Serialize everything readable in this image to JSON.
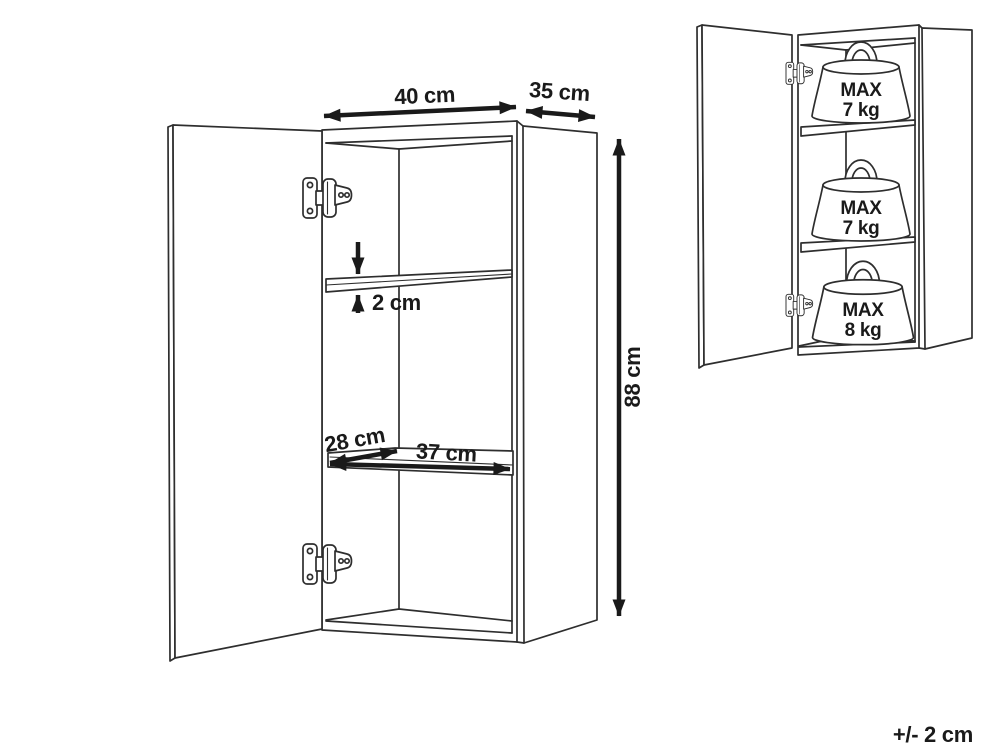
{
  "dimension_view": {
    "width_label": "40 cm",
    "depth_label": "35 cm",
    "height_label": "88 cm",
    "shelf_thickness_label": "2 cm",
    "interior_depth_label": "28 cm",
    "interior_width_label": "37 cm"
  },
  "load_view": {
    "weights": [
      {
        "prefix": "MAX",
        "value": "7 kg"
      },
      {
        "prefix": "MAX",
        "value": "7 kg"
      },
      {
        "prefix": "MAX",
        "value": "8 kg"
      }
    ]
  },
  "footer": {
    "tolerance": "+/- 2 cm"
  },
  "colors": {
    "line": "#2e2e2e",
    "dimension": "#1a1a1a",
    "background": "#ffffff"
  }
}
